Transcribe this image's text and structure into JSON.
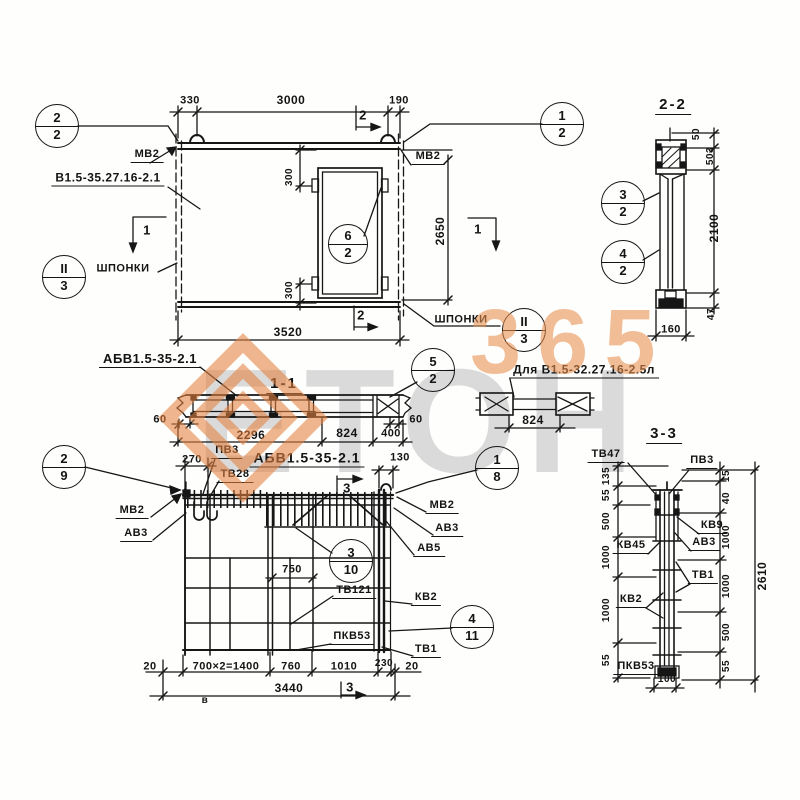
{
  "watermark": {
    "brand": "ЕТОН",
    "number": "365"
  },
  "elevation": {
    "mark": "В1.5-35.27.16-2.1",
    "mv2_left": "МВ2",
    "mv2_right": "МВ2",
    "shponki_left": "ШПОНКИ",
    "shponki_right": "ШПОНКИ",
    "dims": {
      "d330": "330",
      "d3000": "3000",
      "d190": "190",
      "d3520": "3520",
      "d2650": "2650",
      "d300_top": "300",
      "d300_bottom": "300"
    },
    "markers": {
      "m1_left": "1",
      "m1_right": "1",
      "m2_top": "2",
      "m2_bottom": "2"
    },
    "callouts": {
      "tl": [
        "2",
        "2"
      ],
      "tr": [
        "1",
        "2"
      ],
      "keys_left": [
        "II",
        "3"
      ],
      "keys_right": [
        "II",
        "3"
      ],
      "opening": [
        "6",
        "2"
      ]
    }
  },
  "section22": {
    "title": "2-2",
    "dims": {
      "d50": "50",
      "d503": "503",
      "d2100": "2100",
      "d47": "47",
      "d160": "160"
    },
    "callouts": {
      "c3": [
        "3",
        "2"
      ],
      "c4": [
        "4",
        "2"
      ]
    }
  },
  "section11": {
    "title": "1-1",
    "mark": "АБВ1.5-35-2.1",
    "dims": {
      "d60l": "60",
      "d2296": "2296",
      "d824": "824",
      "d400": "400",
      "d60r": "60"
    },
    "callouts": {
      "c5": [
        "5",
        "2"
      ]
    }
  },
  "section_alt": {
    "title": "Для В1.5-32.27.16-2.5л",
    "dims": {
      "d824": "824"
    }
  },
  "section33": {
    "title": "3-3",
    "labels": {
      "tv47": "ТВ47",
      "pv3": "ПВ3",
      "kv9": "КВ9",
      "av3": "АВ3",
      "kv45": "КВ45",
      "tv1": "ТВ1",
      "kv2": "КВ2",
      "pkv53": "ПКВ53"
    },
    "dims_left": [
      "135",
      "55",
      "500",
      "1000",
      "1000",
      "55"
    ],
    "dims_right": [
      "15",
      "40",
      "1000",
      "1000",
      "500",
      "55"
    ],
    "dims": {
      "total": "2610",
      "d100": "100"
    }
  },
  "plan": {
    "title": "АБВ1.5-35-2.1",
    "labels": {
      "pv3": "ПВ3",
      "tv28": "ТВ28",
      "mv2_left": "МВ2",
      "av3_left": "АВ3",
      "mv2_right": "МВ2",
      "av3_right": "АВ3",
      "av5": "АВ5",
      "tv121": "ТВ121",
      "kv2": "КВ2",
      "pkv53": "ПКВ53",
      "tv1": "ТВ1",
      "v": "в"
    },
    "dims": {
      "d270": "270",
      "d130": "130",
      "d750": "750",
      "row": [
        "20",
        "700×2=1400",
        "760",
        "1010",
        "230",
        "20"
      ],
      "total": "3440"
    },
    "markers": {
      "m3_top": "3",
      "m3_bottom": "3"
    },
    "callouts": {
      "c29": [
        "2",
        "9"
      ],
      "c18": [
        "1",
        "8"
      ],
      "c310": [
        "3",
        "10"
      ],
      "c411": [
        "4",
        "11"
      ]
    }
  }
}
